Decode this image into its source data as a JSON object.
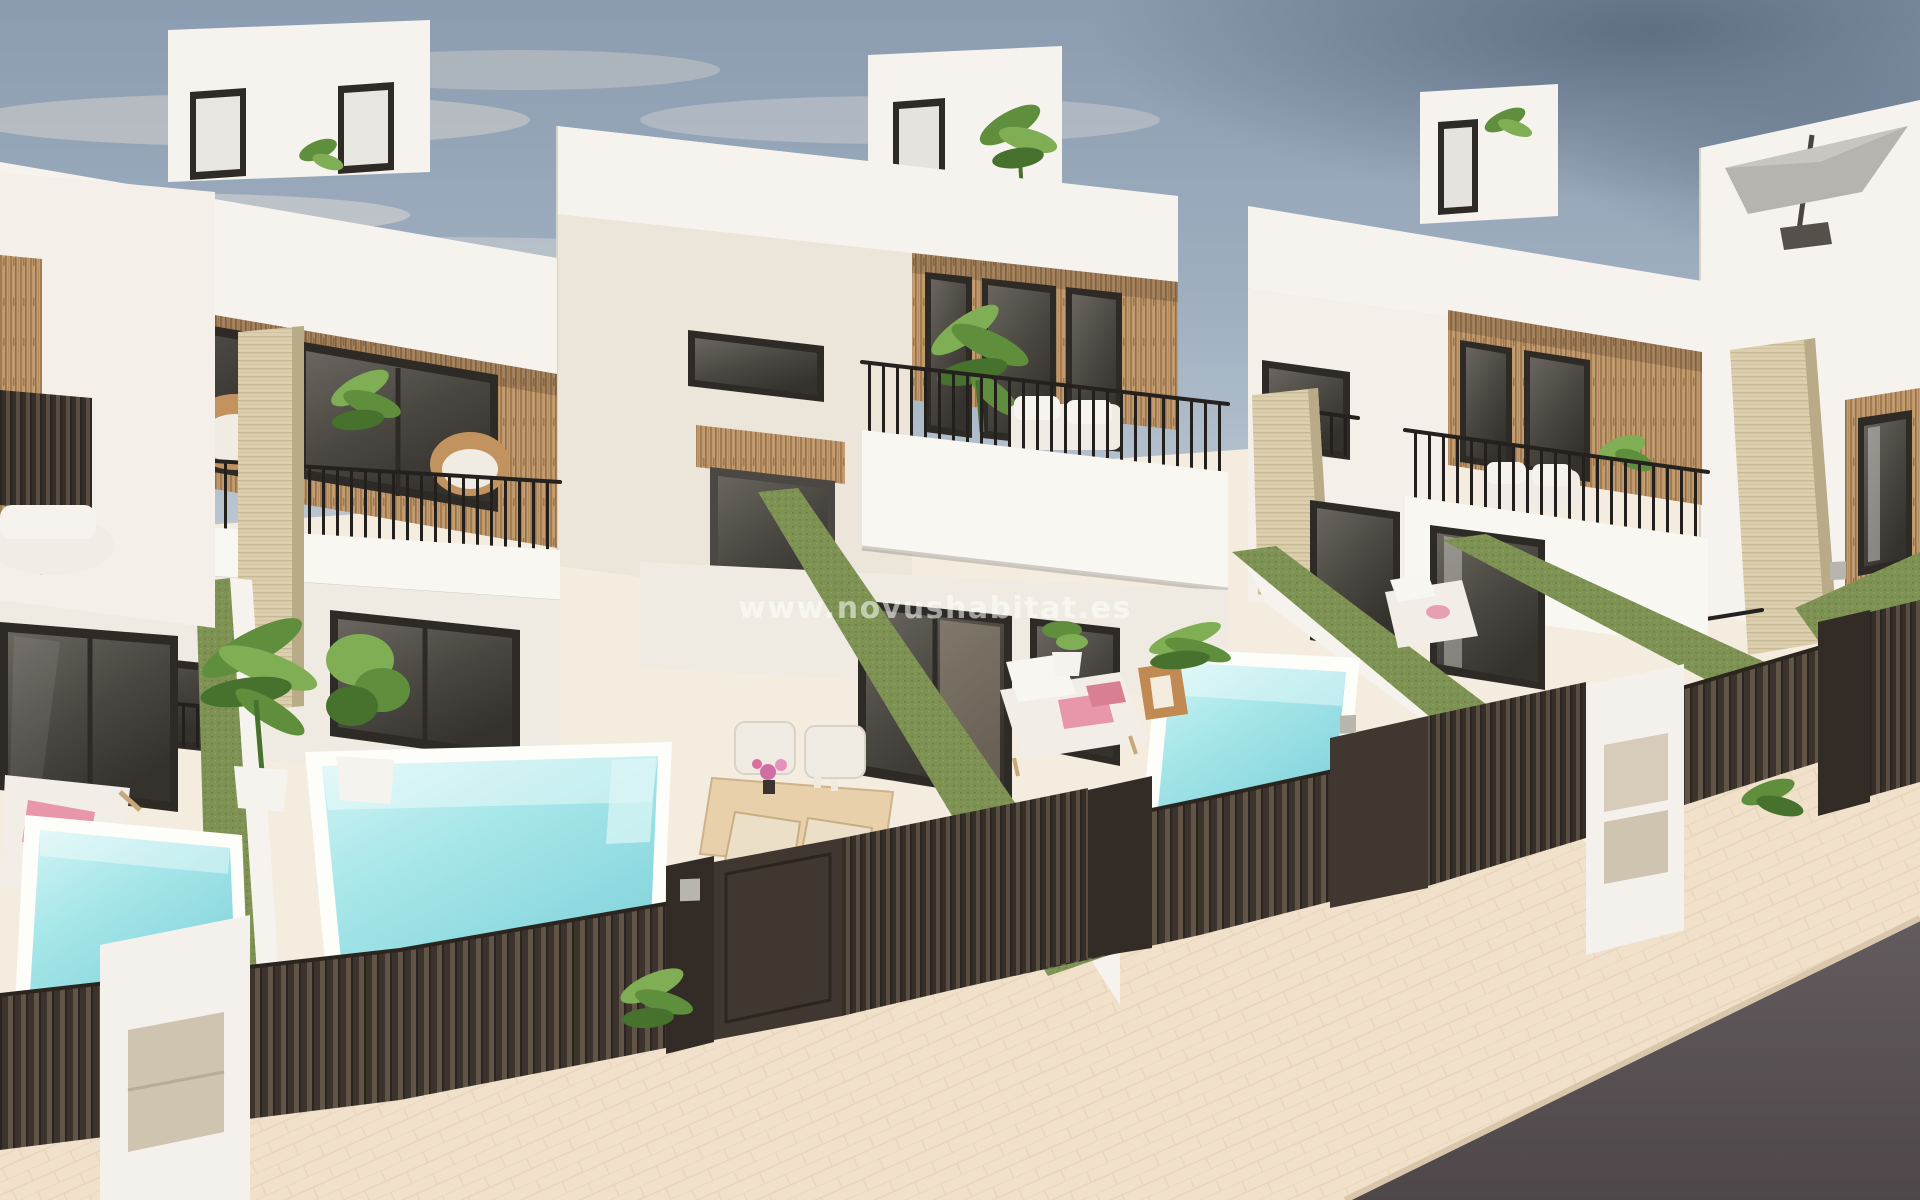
{
  "image": {
    "kind": "3d-architectural-render",
    "subject": "Row of modern white townhouse villas with private pools, viewed from above street level",
    "width_px": 1920,
    "height_px": 1200
  },
  "watermark": {
    "text": "www.novushabitat.es"
  },
  "palette": {
    "sky_top": "#8b9cb0",
    "sky_horizon": "#dcdfe2",
    "cloud_dark": "#5a6a7e",
    "cloud_light": "#d8d3cb",
    "wall_white": "#f6f3ee",
    "wall_shade": "#e9e3da",
    "wood_cladding": "#c49c70",
    "wood_slat_dark": "#92714a",
    "window_frame": "#2e2b27",
    "window_glass": "#4a4741",
    "railing_black": "#221f1c",
    "grass_green": "#7d9253",
    "pool_light": "#d2f4f4",
    "pool_deep": "#7fd2da",
    "travertine": "#dccfae",
    "fence_dark": "#3a322b",
    "gate_dark": "#362f28",
    "sidewalk_beige": "#f1e1cb",
    "road_asphalt": "#575052",
    "towel_pink": "#e897ab",
    "flower_magenta": "#cf6da4",
    "rattan_tan": "#c3935f",
    "parasol_gray": "#b7b3ae"
  },
  "scene": {
    "houses": [
      {
        "id": "house-0",
        "position": "far-left-partial",
        "features": [
          "glass sliding doors",
          "dark privacy screen balcony",
          "sun lounger with pink towel",
          "private pool",
          "white letterbox pillar"
        ]
      },
      {
        "id": "house-1",
        "position": "left",
        "features": [
          "rooftop access box with two doors",
          "wood slat cladding with two large windows",
          "balcony with black railing and rattan chairs",
          "juliet balcony",
          "dining terrace with four chairs and pink flowers",
          "private pool"
        ]
      },
      {
        "id": "house-2",
        "position": "center",
        "features": [
          "rooftop access box with plant",
          "wood slat cladding with glass doors",
          "balcony with white sofa and banana plant",
          "recessed entry with wood lintel",
          "sun lounger with pink towels and side table",
          "private pool"
        ]
      },
      {
        "id": "house-3",
        "position": "right",
        "features": [
          "rooftop access box",
          "wood slat cladding",
          "balcony with white sofa",
          "travertine pillars",
          "artificial grass banks",
          "sun lounger"
        ]
      },
      {
        "id": "house-4",
        "position": "far-right-partial",
        "features": [
          "roof terrace with cantilever parasol",
          "travertine pillar",
          "wood framed window"
        ]
      }
    ],
    "pools_visible": 3,
    "street": {
      "elements": [
        "dark slatted fence",
        "sliding slat gates",
        "solid pedestrian doors",
        "keypad pillars",
        "white letterbox pillars with beige panels",
        "beige paved sidewalk",
        "dark asphalt road"
      ]
    },
    "landscaping": [
      "green grass-topped dividing walls",
      "potted tropical plants",
      "palms"
    ]
  }
}
